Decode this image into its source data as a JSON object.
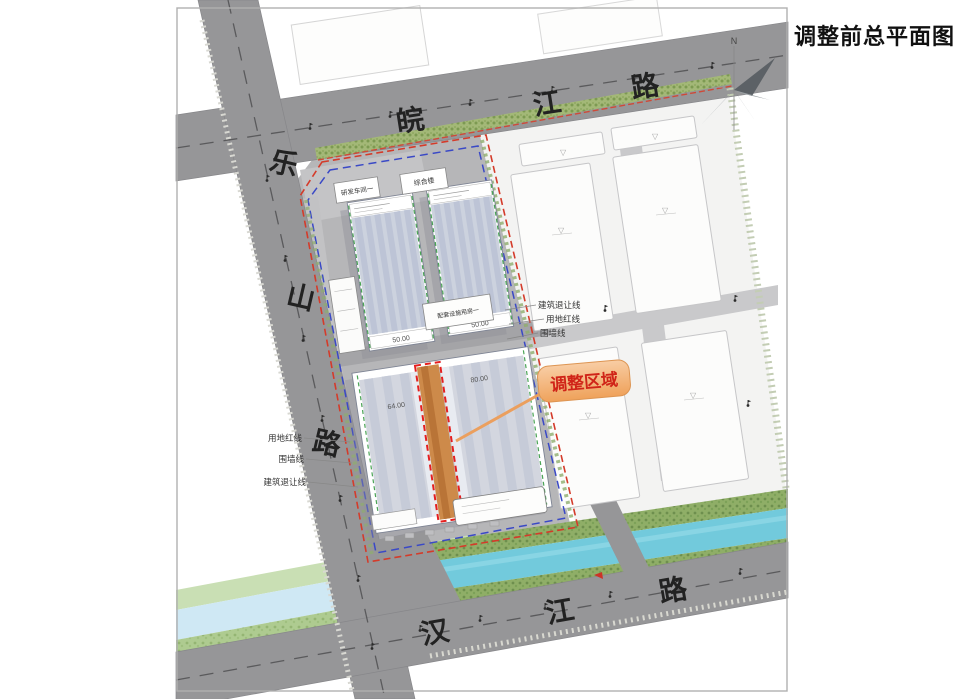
{
  "title": "调整前总平面图",
  "compass": {
    "north_label": "N"
  },
  "roads": {
    "wanjiang": {
      "name": "皖江路",
      "chars": [
        "皖",
        "江",
        "路"
      ]
    },
    "leshan": {
      "name": "乐山路",
      "chars": [
        "乐",
        "山",
        "路"
      ]
    },
    "hanjiang": {
      "name": "汉江路",
      "chars": [
        "汉",
        "江",
        "路"
      ]
    }
  },
  "callout": {
    "label": "调整区域"
  },
  "boundary_labels": {
    "left": [
      "用地红线",
      "围墙线",
      "建筑退让线"
    ],
    "right": [
      "建筑退让线",
      "用地红线",
      "围墙线"
    ]
  },
  "buildings": {
    "strip_a": "研发车间一",
    "strip_b": "综合楼",
    "mid_strip": "配套设施用房一",
    "tower_a_dim": "50.00",
    "tower_b_dim": "50.00",
    "block_dim_left": "64.00",
    "block_dim_right": "80.00",
    "block_dim_vertical": "153.60"
  },
  "colors": {
    "road_gray": "#969698",
    "site_gray": "#b6b6b8",
    "east_ground": "#f3f3f2",
    "river": "#72cadc",
    "river_pale": "#cfe8f4",
    "bank_green": "#93b26d",
    "hedge_green": "#9ab26a",
    "boundary_red": "#d43b2a",
    "boundary_blue": "#3a49c6",
    "adjust_orange": "#cd8a4a",
    "callout_fill": "#f3b079",
    "callout_text": "#d02418",
    "building_fill": "#ccd2de"
  }
}
